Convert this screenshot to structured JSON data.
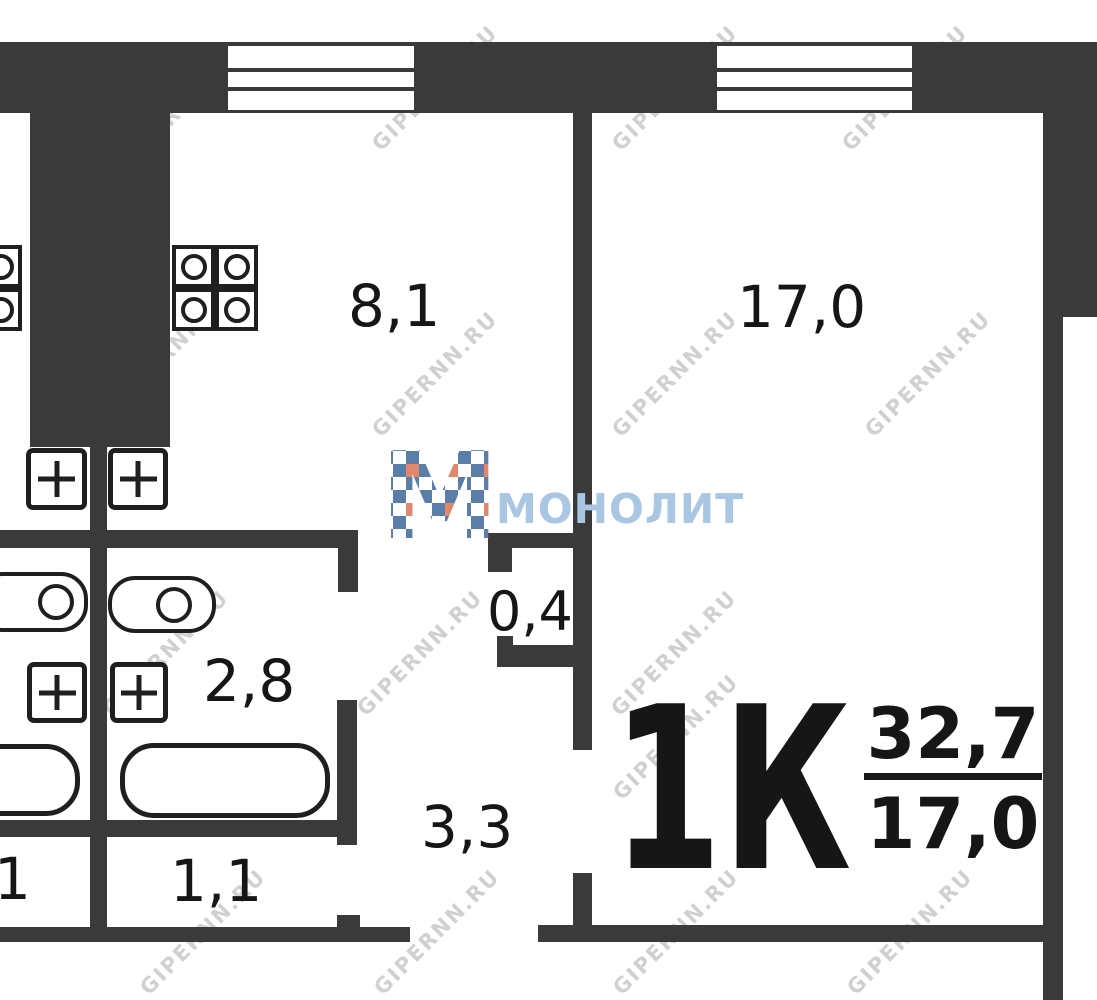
{
  "plan": {
    "areas": {
      "kitchen": "8,1",
      "room": "17,0",
      "closet": "0,4",
      "bathroom": "2,8",
      "hallway": "3,3",
      "entry": "1,1",
      "neighbor_partial": "1"
    },
    "summary": {
      "apartment_type": "1К",
      "total_area": "32,7",
      "living_area": "17,0"
    },
    "fixtures": [
      "gas-stove-icon",
      "gas-stove-icon-neighbor",
      "sink-cross-icon",
      "toilet-icon",
      "bathtub-icon",
      "window-icon",
      "vent-shaft-block"
    ]
  },
  "branding": {
    "watermark_text": "GIPERNN.RU",
    "logo_letter": "М",
    "logo_text": "МОНОЛИТ"
  },
  "colors": {
    "wall": "#3a3a3a",
    "line": "#1f1f1f",
    "text": "#161616",
    "background": "#ffffff",
    "logo_blue": "#5b7ea8",
    "logo_blue_light": "#a9c6e2",
    "logo_orange": "#e0886a",
    "watermark": "rgba(150,150,150,0.45)"
  }
}
